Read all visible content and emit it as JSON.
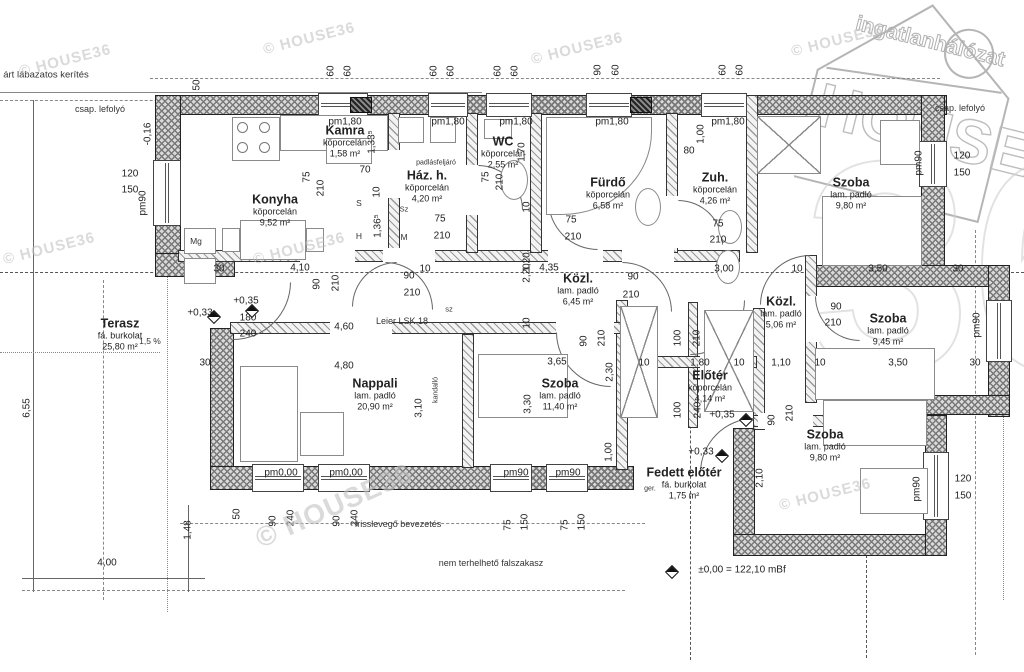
{
  "logo": {
    "line1": "ingatlanhálózat",
    "line2": "HOUSE",
    "line3": "36"
  },
  "watermark_text": "© HOUSE36",
  "watermarks": [
    [
      18,
      52,
      -14,
      15
    ],
    [
      262,
      30,
      -14,
      15
    ],
    [
      530,
      40,
      -14,
      15
    ],
    [
      790,
      32,
      -14,
      15
    ],
    [
      2,
      240,
      -14,
      15
    ],
    [
      252,
      240,
      -14,
      15
    ],
    [
      778,
      486,
      -14,
      15
    ],
    [
      250,
      490,
      -24,
      28
    ]
  ],
  "rooms": [
    {
      "name": "Konyha",
      "material": "köporcelán",
      "area": "9,52 m²",
      "x": 275,
      "y": 210
    },
    {
      "name": "Kamra",
      "material": "köporcelán",
      "area": "1,58 m²",
      "x": 345,
      "y": 141
    },
    {
      "name": "Ház. h.",
      "material": "köporcelán",
      "area": "4,20 m²",
      "x": 427,
      "y": 186
    },
    {
      "name": "WC",
      "material": "köporcelán",
      "area": "2,55 m²",
      "x": 503,
      "y": 152
    },
    {
      "name": "Fürdő",
      "material": "köporcelán",
      "area": "6,58 m²",
      "x": 608,
      "y": 193
    },
    {
      "name": "Zuh.",
      "material": "köporcelán",
      "area": "4,26 m²",
      "x": 715,
      "y": 188
    },
    {
      "name": "Szoba",
      "material": "lam. padló",
      "area": "9,80 m²",
      "x": 851,
      "y": 193
    },
    {
      "name": "Közl.",
      "material": "lam. padló",
      "area": "6,45 m²",
      "x": 578,
      "y": 289
    },
    {
      "name": "Közl.",
      "material": "lam. padló",
      "area": "5,06 m²",
      "x": 781,
      "y": 312
    },
    {
      "name": "Szoba",
      "material": "lam. padló",
      "area": "9,45 m²",
      "x": 888,
      "y": 329
    },
    {
      "name": "Terasz",
      "material": "fá. burkolat",
      "area": "25,80 m²",
      "x": 120,
      "y": 334
    },
    {
      "name": "Nappali",
      "material": "lam. padló",
      "area": "20,90 m²",
      "x": 375,
      "y": 394
    },
    {
      "name": "Szoba",
      "material": "lam. padló",
      "area": "11,40 m²",
      "x": 560,
      "y": 394
    },
    {
      "name": "Előtér",
      "material": "köporcelán",
      "area": "4,14 m²",
      "x": 710,
      "y": 386
    },
    {
      "name": "Szoba",
      "material": "lam. padló",
      "area": "9,80 m²",
      "x": 825,
      "y": 445
    },
    {
      "name": "Fedett előtér",
      "material": "fá. burkolat",
      "area": "1,75 m²",
      "x": 684,
      "y": 483
    }
  ],
  "dims": [
    [
      "50",
      197,
      85,
      1
    ],
    [
      "60",
      331,
      71,
      1
    ],
    [
      "60",
      348,
      71,
      1
    ],
    [
      "60",
      434,
      71,
      1
    ],
    [
      "60",
      451,
      71,
      1
    ],
    [
      "60",
      498,
      71,
      1
    ],
    [
      "60",
      515,
      71,
      1
    ],
    [
      "90",
      598,
      70,
      1
    ],
    [
      "60",
      616,
      70,
      1
    ],
    [
      "60",
      723,
      70,
      1
    ],
    [
      "60",
      740,
      70,
      1
    ],
    [
      "pm1,80",
      345,
      122,
      0
    ],
    [
      "pm1,80",
      448,
      122,
      0
    ],
    [
      "pm1,80",
      516,
      122,
      0
    ],
    [
      "pm1,80",
      612,
      122,
      0
    ],
    [
      "pm1,80",
      728,
      122,
      0
    ],
    [
      "-0,16",
      148,
      134,
      1
    ],
    [
      "120",
      130,
      174,
      0
    ],
    [
      "150",
      130,
      190,
      0
    ],
    [
      "pm90",
      143,
      203,
      1
    ],
    [
      "75",
      307,
      177,
      1
    ],
    [
      "210",
      321,
      188,
      1
    ],
    [
      "70",
      365,
      170,
      0
    ],
    [
      "10",
      377,
      192,
      1
    ],
    [
      "1,33⁵",
      372,
      142,
      1
    ],
    [
      "1,36⁵",
      378,
      226,
      1
    ],
    [
      "75",
      440,
      219,
      0
    ],
    [
      "210",
      442,
      236,
      0
    ],
    [
      "75",
      486,
      177,
      1
    ],
    [
      "210",
      500,
      182,
      1
    ],
    [
      "1,70",
      522,
      152,
      1
    ],
    [
      "10",
      527,
      207,
      1
    ],
    [
      "75",
      571,
      220,
      0
    ],
    [
      "210",
      573,
      237,
      0
    ],
    [
      "1,20",
      527,
      262,
      1
    ],
    [
      "80",
      689,
      151,
      0
    ],
    [
      "1,00",
      701,
      134,
      1
    ],
    [
      "75",
      718,
      224,
      0
    ],
    [
      "210",
      718,
      240,
      0
    ],
    [
      "120",
      962,
      156,
      0
    ],
    [
      "150",
      962,
      173,
      0
    ],
    [
      "pm90",
      919,
      163,
      1
    ],
    [
      "30",
      219,
      269,
      0
    ],
    [
      "4,10",
      300,
      268,
      0
    ],
    [
      "90",
      317,
      284,
      1
    ],
    [
      "210",
      336,
      283,
      1
    ],
    [
      "90",
      409,
      276,
      0
    ],
    [
      "10",
      425,
      269,
      0
    ],
    [
      "210",
      412,
      293,
      0
    ],
    [
      "2,20",
      527,
      273,
      1
    ],
    [
      "4,35",
      549,
      268,
      0
    ],
    [
      "90",
      633,
      277,
      0
    ],
    [
      "210",
      631,
      295,
      0
    ],
    [
      "3,00",
      724,
      269,
      0
    ],
    [
      "10",
      797,
      269,
      0
    ],
    [
      "3,50",
      878,
      269,
      0
    ],
    [
      "30",
      958,
      269,
      0
    ],
    [
      "90",
      836,
      307,
      0
    ],
    [
      "210",
      833,
      323,
      0
    ],
    [
      "pm90",
      977,
      325,
      1
    ],
    [
      "+0,35",
      246,
      301,
      0
    ],
    [
      "+0,33",
      200,
      313,
      0
    ],
    [
      "180",
      248,
      318,
      0
    ],
    [
      "240",
      248,
      334,
      0
    ],
    [
      "30",
      205,
      363,
      0
    ],
    [
      "4,60",
      344,
      327,
      0
    ],
    [
      "4,80",
      344,
      366,
      0
    ],
    [
      "10",
      527,
      323,
      1
    ],
    [
      "90",
      584,
      341,
      1
    ],
    [
      "210",
      602,
      338,
      1
    ],
    [
      "3,65",
      557,
      362,
      0
    ],
    [
      "2,30",
      610,
      372,
      1
    ],
    [
      "10",
      644,
      363,
      0
    ],
    [
      "1,80",
      700,
      363,
      0
    ],
    [
      "10",
      739,
      363,
      0
    ],
    [
      "1,10",
      781,
      363,
      0
    ],
    [
      "10",
      820,
      363,
      0
    ],
    [
      "3,50",
      898,
      363,
      0
    ],
    [
      "30",
      975,
      363,
      0
    ],
    [
      "100",
      678,
      338,
      1
    ],
    [
      "210",
      697,
      338,
      1
    ],
    [
      "100",
      678,
      410,
      1
    ],
    [
      "240",
      698,
      410,
      1
    ],
    [
      "3,30",
      528,
      404,
      1
    ],
    [
      "3,10",
      419,
      408,
      1
    ],
    [
      "1,00",
      609,
      452,
      1
    ],
    [
      "90",
      772,
      420,
      1
    ],
    [
      "210",
      790,
      413,
      1
    ],
    [
      "+0,35",
      722,
      415,
      0
    ],
    [
      "+0,33",
      701,
      452,
      0
    ],
    [
      "2,10",
      760,
      478,
      1
    ],
    [
      "pm0,00",
      281,
      473,
      0
    ],
    [
      "pm0,00",
      346,
      473,
      0
    ],
    [
      "pm90",
      516,
      473,
      0
    ],
    [
      "pm90",
      568,
      473,
      0
    ],
    [
      "50",
      237,
      514,
      1
    ],
    [
      "90",
      273,
      521,
      1
    ],
    [
      "240",
      291,
      518,
      1
    ],
    [
      "90",
      337,
      521,
      1
    ],
    [
      "240",
      355,
      518,
      1
    ],
    [
      "75",
      508,
      525,
      1
    ],
    [
      "150",
      525,
      522,
      1
    ],
    [
      "75",
      565,
      525,
      1
    ],
    [
      "150",
      582,
      522,
      1
    ],
    [
      "1,48",
      188,
      530,
      1
    ],
    [
      "6,55",
      27,
      408,
      1
    ],
    [
      "4,00",
      107,
      563,
      0
    ],
    [
      "120",
      963,
      479,
      0
    ],
    [
      "150",
      963,
      496,
      0
    ],
    [
      "pm90",
      917,
      489,
      1
    ],
    [
      "±0,00 = 122,10 mBf",
      742,
      570,
      0
    ]
  ],
  "notes": [
    [
      "árt lábazatos kerítés",
      46,
      75,
      0,
      9.5
    ],
    [
      "csap. lefolyó",
      100,
      109,
      0,
      9
    ],
    [
      "csap. lefolyó",
      960,
      108,
      0,
      9
    ],
    [
      "padlásfeljáró",
      436,
      163,
      0,
      7
    ],
    [
      "Leier LSK 18",
      402,
      321,
      0,
      9
    ],
    [
      "sz",
      449,
      309,
      0,
      7.5
    ],
    [
      "kandalló",
      436,
      390,
      1,
      7
    ],
    [
      "1,5 %",
      150,
      341,
      0,
      8.5
    ],
    [
      "S",
      359,
      203,
      0,
      8.5
    ],
    [
      "H",
      359,
      236,
      0,
      8.5
    ],
    [
      "Sz",
      404,
      209,
      0,
      7.5
    ],
    [
      "M",
      404,
      237,
      0,
      8.5
    ],
    [
      "Mg",
      196,
      241,
      0,
      8.5
    ],
    [
      "ger.",
      650,
      489,
      0,
      7
    ],
    [
      "frisslevegő bevezetés",
      398,
      524,
      0,
      9
    ],
    [
      "nem terhelhető falszakasz",
      491,
      563,
      0,
      9
    ]
  ],
  "walls_ext": [
    [
      155,
      95,
      792,
      20
    ],
    [
      155,
      95,
      26,
      162
    ],
    [
      155,
      253,
      80,
      24
    ],
    [
      210,
      328,
      24,
      162
    ],
    [
      210,
      466,
      424,
      24
    ],
    [
      733,
      428,
      22,
      128
    ],
    [
      733,
      534,
      214,
      22
    ],
    [
      925,
      415,
      22,
      141
    ],
    [
      921,
      95,
      24,
      192
    ],
    [
      808,
      265,
      202,
      22
    ],
    [
      988,
      265,
      22,
      152
    ],
    [
      845,
      395,
      165,
      20
    ]
  ],
  "walls_int": [
    [
      178,
      250,
      562,
      12
    ],
    [
      388,
      113,
      12,
      140
    ],
    [
      466,
      113,
      12,
      140
    ],
    [
      530,
      113,
      12,
      140
    ],
    [
      666,
      113,
      12,
      140
    ],
    [
      746,
      95,
      12,
      158
    ],
    [
      805,
      255,
      12,
      148
    ],
    [
      616,
      300,
      12,
      170
    ],
    [
      688,
      302,
      10,
      126
    ],
    [
      753,
      308,
      12,
      122
    ],
    [
      230,
      322,
      405,
      12
    ],
    [
      462,
      334,
      12,
      134
    ],
    [
      753,
      415,
      174,
      12
    ],
    [
      632,
      356,
      125,
      12
    ]
  ],
  "door_gaps": [
    [
      300,
      248,
      55,
      16
    ],
    [
      383,
      248,
      52,
      16
    ],
    [
      548,
      248,
      55,
      16
    ],
    [
      622,
      248,
      52,
      16
    ],
    [
      330,
      320,
      62,
      16
    ],
    [
      556,
      320,
      58,
      16
    ],
    [
      700,
      354,
      48,
      16
    ],
    [
      758,
      413,
      55,
      16
    ],
    [
      806,
      296,
      14,
      46
    ],
    [
      466,
      165,
      14,
      50
    ],
    [
      666,
      196,
      14,
      52
    ],
    [
      388,
      150,
      12,
      48
    ]
  ],
  "windows": [
    [
      318,
      93,
      50,
      24,
      0
    ],
    [
      428,
      93,
      40,
      24,
      0
    ],
    [
      486,
      93,
      46,
      24,
      0
    ],
    [
      586,
      93,
      46,
      24,
      0
    ],
    [
      701,
      93,
      46,
      24,
      0
    ],
    [
      153,
      160,
      28,
      66,
      1
    ],
    [
      919,
      141,
      28,
      46,
      1
    ],
    [
      986,
      300,
      26,
      62,
      1
    ],
    [
      923,
      452,
      26,
      68,
      1
    ],
    [
      252,
      464,
      52,
      28,
      0
    ],
    [
      318,
      464,
      52,
      28,
      0
    ],
    [
      490,
      464,
      42,
      28,
      0
    ],
    [
      546,
      464,
      42,
      28,
      0
    ]
  ],
  "blocks": [
    [
      350,
      97,
      22,
      16
    ],
    [
      630,
      97,
      22,
      16
    ]
  ],
  "furniture": [
    {
      "k": "stove",
      "x": 232,
      "y": 117,
      "w": 48,
      "h": 44
    },
    {
      "k": "rect",
      "x": 280,
      "y": 115,
      "w": 108,
      "h": 36
    },
    {
      "k": "rect",
      "x": 240,
      "y": 220,
      "w": 66,
      "h": 40
    },
    {
      "k": "rect",
      "x": 222,
      "y": 228,
      "w": 18,
      "h": 24
    },
    {
      "k": "rect",
      "x": 306,
      "y": 228,
      "w": 18,
      "h": 24
    },
    {
      "k": "rect",
      "x": 184,
      "y": 228,
      "w": 32,
      "h": 26
    },
    {
      "k": "rect",
      "x": 184,
      "y": 258,
      "w": 32,
      "h": 26
    },
    {
      "k": "rect",
      "x": 398,
      "y": 117,
      "w": 26,
      "h": 26
    },
    {
      "k": "rect",
      "x": 430,
      "y": 117,
      "w": 26,
      "h": 26
    },
    {
      "k": "rect",
      "x": 484,
      "y": 119,
      "w": 28,
      "h": 20
    },
    {
      "k": "oval",
      "x": 500,
      "y": 160,
      "w": 28,
      "h": 40
    },
    {
      "k": "tub",
      "x": 546,
      "y": 117,
      "w": 106,
      "h": 98
    },
    {
      "k": "oval",
      "x": 635,
      "y": 188,
      "w": 26,
      "h": 38
    },
    {
      "k": "oval",
      "x": 718,
      "y": 210,
      "w": 24,
      "h": 34
    },
    {
      "k": "oval",
      "x": 716,
      "y": 250,
      "w": 24,
      "h": 34
    },
    {
      "k": "rect",
      "x": 822,
      "y": 196,
      "w": 100,
      "h": 70
    },
    {
      "k": "xbox",
      "x": 757,
      "y": 116,
      "w": 64,
      "h": 58
    },
    {
      "k": "rect",
      "x": 880,
      "y": 120,
      "w": 40,
      "h": 45
    },
    {
      "k": "rect",
      "x": 815,
      "y": 348,
      "w": 120,
      "h": 52
    },
    {
      "k": "rect",
      "x": 823,
      "y": 400,
      "w": 104,
      "h": 46
    },
    {
      "k": "rect",
      "x": 860,
      "y": 468,
      "w": 68,
      "h": 46
    },
    {
      "k": "rect",
      "x": 478,
      "y": 354,
      "w": 90,
      "h": 64
    },
    {
      "k": "rect",
      "x": 240,
      "y": 366,
      "w": 58,
      "h": 96
    },
    {
      "k": "rect",
      "x": 300,
      "y": 412,
      "w": 44,
      "h": 44
    },
    {
      "k": "xbox",
      "x": 620,
      "y": 306,
      "w": 38,
      "h": 112
    },
    {
      "k": "xbox",
      "x": 704,
      "y": 310,
      "w": 50,
      "h": 102
    },
    {
      "k": "rect",
      "x": 326,
      "y": 138,
      "w": 46,
      "h": 26
    }
  ],
  "arcs": [
    [
      352,
      262,
      45,
      "tl"
    ],
    [
      385,
      262,
      48,
      "tr"
    ],
    [
      478,
      165,
      45,
      "tr"
    ],
    [
      548,
      200,
      50,
      "bl"
    ],
    [
      622,
      262,
      50,
      "tr"
    ],
    [
      678,
      200,
      45,
      "tr"
    ],
    [
      760,
      255,
      50,
      "tl"
    ],
    [
      815,
      296,
      45,
      "bl"
    ],
    [
      233,
      282,
      58,
      "br"
    ],
    [
      556,
      332,
      55,
      "bl"
    ],
    [
      700,
      418,
      55,
      "tl"
    ],
    [
      690,
      300,
      55,
      "br"
    ]
  ],
  "markers": [
    [
      214,
      317
    ],
    [
      252,
      311
    ],
    [
      746,
      420
    ],
    [
      722,
      456
    ],
    [
      672,
      572
    ]
  ],
  "lines": [
    [
      0,
      92,
      482,
      92,
      "solid"
    ],
    [
      0,
      100,
      482,
      100,
      "dashed"
    ],
    [
      150,
      78,
      940,
      78,
      "dashed"
    ],
    [
      0,
      272,
      1024,
      272,
      "dashdot"
    ],
    [
      167,
      100,
      167,
      612,
      "dotted"
    ],
    [
      33,
      100,
      33,
      592,
      "dim"
    ],
    [
      0,
      352,
      160,
      352,
      "dotted"
    ],
    [
      103,
      280,
      103,
      600,
      "dashed"
    ],
    [
      180,
      523,
      645,
      523,
      "dashed"
    ],
    [
      22,
      590,
      625,
      590,
      "dashed"
    ],
    [
      22,
      578,
      205,
      578,
      "dim"
    ],
    [
      188,
      505,
      188,
      592,
      "dim"
    ],
    [
      690,
      360,
      690,
      660,
      "dashdot"
    ],
    [
      866,
      540,
      866,
      658,
      "dashdot"
    ],
    [
      975,
      230,
      975,
      655,
      "dashed"
    ],
    [
      1003,
      330,
      1003,
      600,
      "dotted"
    ]
  ]
}
